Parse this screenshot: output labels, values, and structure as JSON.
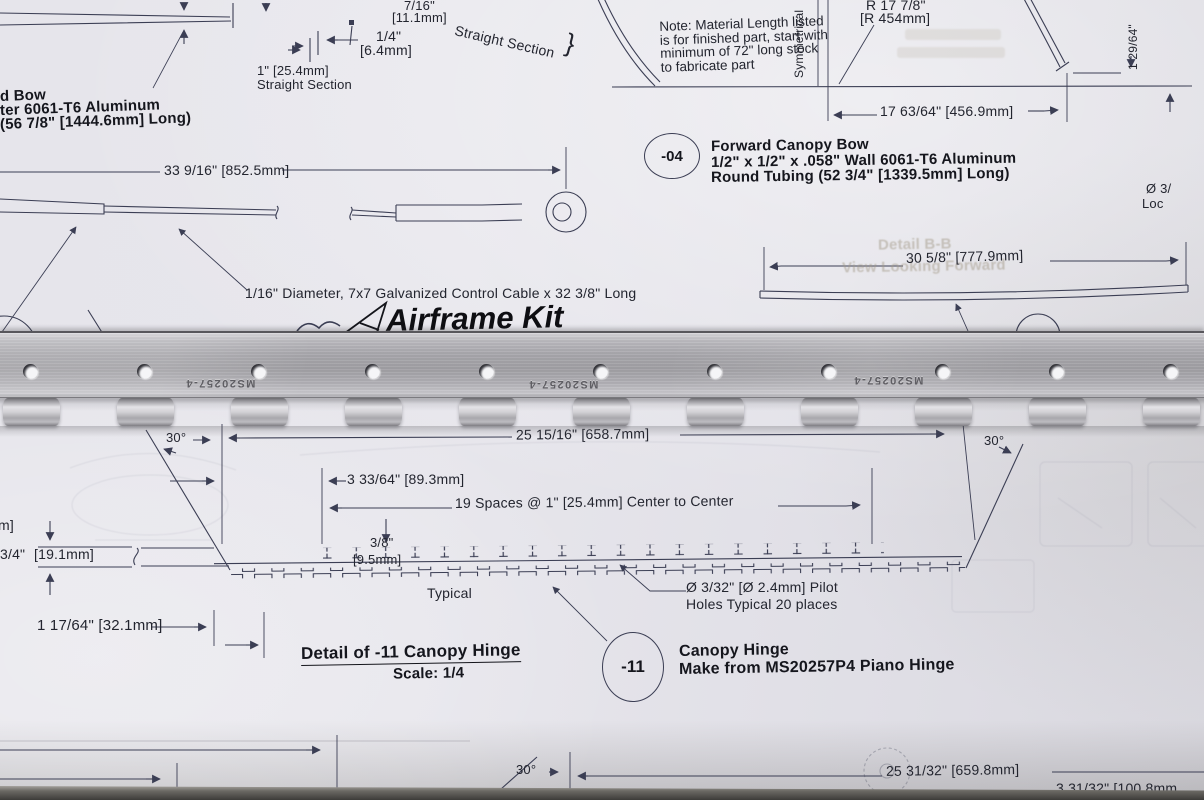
{
  "colors": {
    "paper": "#e6e5eb",
    "ink": "#3b3e54",
    "text": "#23252f",
    "metal": "#a9a8ad",
    "ghost_text": "#a29987",
    "table_edge": "#3d3c39"
  },
  "sheet": {
    "part_top_left": {
      "l1": "d Bow",
      "l2": "ter 6061-T6 Aluminum",
      "l3": "(56 7/8\" [1444.6mm] Long)"
    },
    "top_dims": {
      "d7_16": "7/16\"",
      "d7_16mm": "[11.1mm]",
      "d1_4": "1/4\"",
      "d1_4mm": "[6.4mm]",
      "straight_section": "Straight Section",
      "brace": "}",
      "d1in": "1\" [25.4mm]",
      "straight_section2": "Straight Section"
    },
    "note": {
      "l1": "Note: Material Length listed",
      "l2": "is for finished part, start with",
      "l3": "minimum of 72\" long stock",
      "l4": "to fabricate part"
    },
    "bow04": {
      "balloon": "-04",
      "title": "Forward Canopy Bow",
      "spec1": "1/2\" x 1/2\" x .058\" Wall 6061-T6 Aluminum",
      "spec2": "Round Tubing  (52 3/4\" [1339.5mm] Long)",
      "radius1": "R 17 7/8\"",
      "radius2": "[R 454mm]",
      "symmetrical": "Symmetrical",
      "dim_width": "17 63/64\"  [456.9mm]",
      "dim_height": "1 29/64\""
    },
    "cable": {
      "dim": "33 9/16\" [852.5mm]",
      "spec": "1/16\" Diameter, 7x7 Galvanized Control Cable x 32 3/8\" Long"
    },
    "strip": {
      "dim": "30 5/8\"  [777.9mm]"
    },
    "right_edge": {
      "dia": "Ø 3/",
      "loc": "Loc"
    },
    "ghost": {
      "detail": "Detail B-B",
      "view": "View Looking Forward"
    },
    "logo": "Airframe Kit",
    "hinge11": {
      "angle_left": "30°",
      "angle_right": "30°",
      "dim_top": "25 15/16\"  [658.7mm]",
      "dim_hole_offset": "3 33/64\"  [89.3mm]",
      "dim_spaces": "19 Spaces @ 1\" [25.4mm] Center to Center",
      "thickness": "3/8\"",
      "thickness_mm": "[9.5mm]",
      "typical": "Typical",
      "pilot1": "Ø 3/32\"  [Ø 2.4mm]  Pilot",
      "pilot2": "Holes Typical 20 places",
      "cut_mm": "m]",
      "width": "3/4\"",
      "width_mm": "[19.1mm]",
      "end_offset": "1 17/64\"  [32.1mm]",
      "detail_title": "Detail of -11 Canopy Hinge",
      "detail_scale": "Scale: 1/4",
      "balloon": "-11",
      "name": "Canopy Hinge",
      "make_from": "Make from MS20257P4 Piano Hinge"
    },
    "bottom": {
      "angle": "30°",
      "dim_long": "25 31/32\"  [659.8mm]",
      "dim_short": "3 31/32\"  [100.8mm"
    }
  },
  "hinge_part": {
    "stamp": "MS20257-4"
  }
}
